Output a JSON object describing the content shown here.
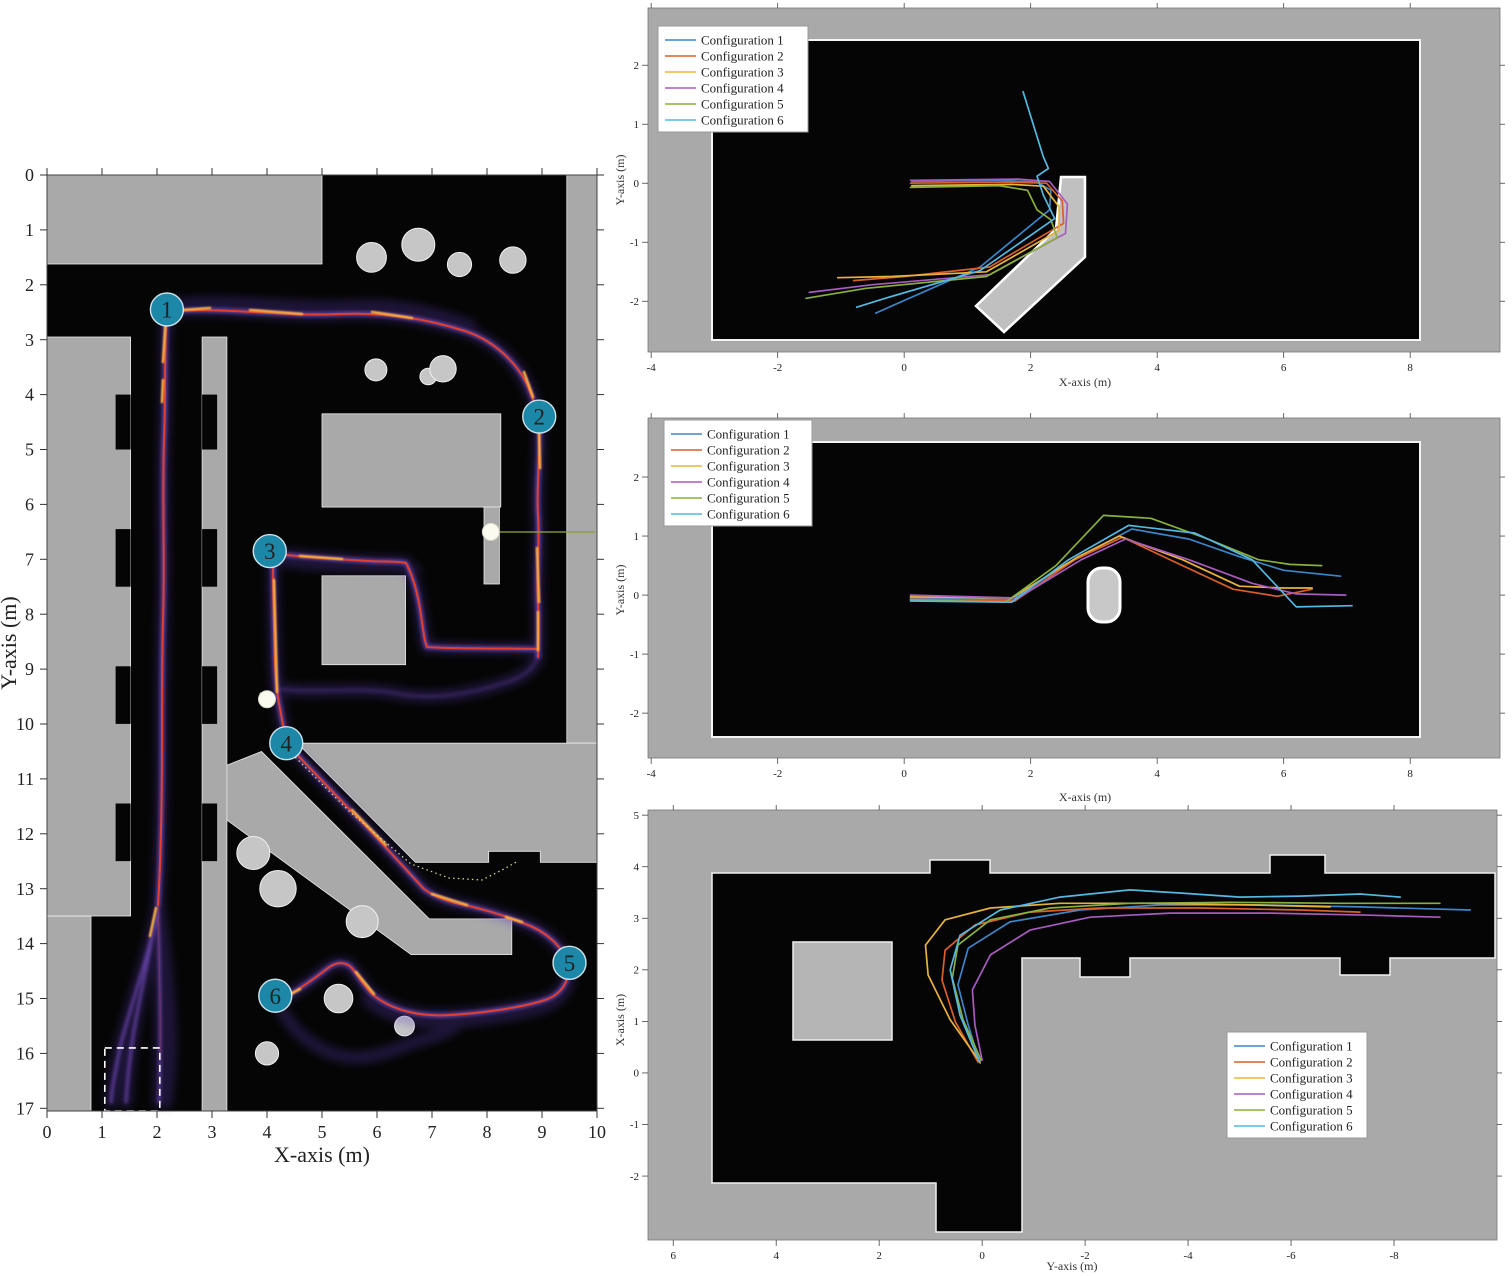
{
  "figure": {
    "background": "#ffffff",
    "wall_gray": "#a9a9a9",
    "obstacle_gray": "#c6c6c6",
    "free_space_black": "#050505",
    "waypoint_badge_color": "#1d87a8",
    "heat_core_color": "#e8402a",
    "heat_glow_color": "#5b3db8",
    "heat_hot_color": "#ffb43e"
  },
  "chart_data": {
    "type": "line",
    "description_units": "meters",
    "configs": [
      {
        "label": "Configuration 1",
        "color": "#3d85c8"
      },
      {
        "label": "Configuration 2",
        "color": "#d95f2b"
      },
      {
        "label": "Configuration 3",
        "color": "#e8b33c"
      },
      {
        "label": "Configuration 4",
        "color": "#a85bc0"
      },
      {
        "label": "Configuration 5",
        "color": "#8ab03c"
      },
      {
        "label": "Configuration 6",
        "color": "#55b8e0"
      }
    ],
    "left_heatmap": {
      "xlabel": "X-axis (m)",
      "ylabel": "Y-axis (m)",
      "xlim": [
        0,
        10
      ],
      "ylim": [
        0,
        17
      ],
      "x_ticks": [
        0,
        1,
        2,
        3,
        4,
        5,
        6,
        7,
        8,
        9,
        10
      ],
      "y_ticks": [
        0,
        1,
        2,
        3,
        4,
        5,
        6,
        7,
        8,
        9,
        10,
        11,
        12,
        13,
        14,
        15,
        16,
        17
      ],
      "waypoints": [
        {
          "id": "1",
          "x": 2.18,
          "y": 2.45
        },
        {
          "id": "2",
          "x": 8.95,
          "y": 4.4
        },
        {
          "id": "3",
          "x": 4.05,
          "y": 6.85
        },
        {
          "id": "4",
          "x": 4.35,
          "y": 10.35
        },
        {
          "id": "5",
          "x": 9.5,
          "y": 14.35
        },
        {
          "id": "6",
          "x": 4.15,
          "y": 14.95
        }
      ],
      "door_markers": [
        {
          "x": 8.07,
          "y": 6.5
        },
        {
          "x": 4.0,
          "y": 9.55
        }
      ],
      "start_zone": {
        "x0": 1.05,
        "y0": 15.9,
        "x1": 2.05,
        "y1": 17.0
      },
      "route_estimate": [
        [
          2.18,
          2.45
        ],
        [
          8.0,
          2.6
        ],
        [
          8.95,
          4.4
        ],
        [
          8.9,
          6.5
        ],
        [
          8.85,
          8.7
        ],
        [
          6.9,
          8.6
        ],
        [
          6.6,
          7.05
        ],
        [
          4.2,
          6.85
        ],
        [
          4.15,
          9.5
        ],
        [
          4.35,
          10.35
        ],
        [
          6.9,
          13.05
        ],
        [
          8.65,
          13.6
        ],
        [
          9.5,
          14.35
        ],
        [
          8.6,
          15.0
        ],
        [
          5.5,
          14.6
        ],
        [
          4.15,
          14.95
        ],
        [
          1.6,
          16.5
        ]
      ]
    },
    "panels": [
      {
        "id": "top",
        "xlabel": "X-axis (m)",
        "ylabel": "Y-axis (m)",
        "x_ticks": [
          -4,
          -2,
          0,
          2,
          4,
          6,
          8
        ],
        "y_ticks": [
          2,
          1,
          0,
          -1,
          -2
        ],
        "xlim": [
          -4.05,
          9.42
        ],
        "ylim": [
          -2.86,
          2.97
        ],
        "legend_position": "top-left",
        "series": [
          {
            "config": 0,
            "points": [
              [
                0.12,
                0.03
              ],
              [
                1.5,
                0.05
              ],
              [
                2.1,
                0.02
              ],
              [
                2.32,
                -0.12
              ],
              [
                2.3,
                -0.45
              ],
              [
                1.2,
                -1.42
              ],
              [
                -0.45,
                -2.2
              ]
            ]
          },
          {
            "config": 1,
            "points": [
              [
                0.1,
                0
              ],
              [
                1.6,
                0.02
              ],
              [
                2.25,
                0
              ],
              [
                2.5,
                -0.3
              ],
              [
                2.52,
                -0.68
              ],
              [
                1.35,
                -1.42
              ],
              [
                0,
                -1.58
              ],
              [
                -0.8,
                -1.65
              ]
            ]
          },
          {
            "config": 2,
            "points": [
              [
                0.12,
                -0.04
              ],
              [
                1.7,
                -0.02
              ],
              [
                2.2,
                -0.05
              ],
              [
                2.45,
                -0.4
              ],
              [
                2.45,
                -0.8
              ],
              [
                1.3,
                -1.5
              ],
              [
                -0.2,
                -1.58
              ],
              [
                -1.05,
                -1.6
              ]
            ]
          },
          {
            "config": 3,
            "points": [
              [
                0.1,
                0.05
              ],
              [
                1.8,
                0.07
              ],
              [
                2.3,
                0.03
              ],
              [
                2.58,
                -0.35
              ],
              [
                2.55,
                -0.85
              ],
              [
                1.35,
                -1.55
              ],
              [
                -0.5,
                -1.72
              ],
              [
                -1.5,
                -1.85
              ]
            ]
          },
          {
            "config": 4,
            "points": [
              [
                0.1,
                -0.07
              ],
              [
                1.5,
                -0.04
              ],
              [
                1.95,
                -0.12
              ],
              [
                2.1,
                -0.45
              ],
              [
                2.32,
                -0.62
              ],
              [
                2.42,
                -0.92
              ],
              [
                1.3,
                -1.58
              ],
              [
                -0.6,
                -1.78
              ],
              [
                -1.55,
                -1.95
              ]
            ]
          },
          {
            "config": 5,
            "points": [
              [
                1.88,
                1.55
              ],
              [
                2.2,
                0.45
              ],
              [
                2.28,
                0.25
              ],
              [
                2.1,
                0.12
              ],
              [
                2.2,
                -0.2
              ],
              [
                2.38,
                -0.6
              ],
              [
                1.2,
                -1.48
              ],
              [
                -0.3,
                -1.95
              ],
              [
                -0.75,
                -2.1
              ]
            ]
          }
        ]
      },
      {
        "id": "middle",
        "xlabel": "X-axis (m)",
        "ylabel": "Y-axis (m)",
        "x_ticks": [
          -4,
          -2,
          0,
          2,
          4,
          6,
          8
        ],
        "y_ticks": [
          2,
          1,
          0,
          -1,
          -2
        ],
        "xlim": [
          -4.05,
          9.42
        ],
        "ylim": [
          -2.76,
          3.0
        ],
        "legend_position": "top-left",
        "series": [
          {
            "config": 0,
            "points": [
              [
                0.1,
                -0.05
              ],
              [
                1.7,
                -0.08
              ],
              [
                2.6,
                0.55
              ],
              [
                3.6,
                1.12
              ],
              [
                4.5,
                0.95
              ],
              [
                5.3,
                0.65
              ],
              [
                6.0,
                0.42
              ],
              [
                6.9,
                0.32
              ]
            ]
          },
          {
            "config": 1,
            "points": [
              [
                0.1,
                -0.07
              ],
              [
                1.75,
                -0.1
              ],
              [
                2.7,
                0.6
              ],
              [
                3.45,
                0.98
              ],
              [
                4.3,
                0.55
              ],
              [
                5.2,
                0.1
              ],
              [
                5.9,
                -0.02
              ],
              [
                6.45,
                0.1
              ]
            ]
          },
          {
            "config": 2,
            "points": [
              [
                0.1,
                -0.03
              ],
              [
                1.7,
                -0.05
              ],
              [
                2.75,
                0.65
              ],
              [
                3.4,
                1.0
              ],
              [
                4.4,
                0.6
              ],
              [
                5.3,
                0.15
              ],
              [
                6.0,
                0.12
              ],
              [
                6.45,
                0.12
              ]
            ]
          },
          {
            "config": 3,
            "points": [
              [
                0.1,
                0.0
              ],
              [
                1.8,
                -0.05
              ],
              [
                2.8,
                0.6
              ],
              [
                3.5,
                0.95
              ],
              [
                4.5,
                0.6
              ],
              [
                5.5,
                0.2
              ],
              [
                6.2,
                0.02
              ],
              [
                6.98,
                0.0
              ]
            ]
          },
          {
            "config": 4,
            "points": [
              [
                0.1,
                -0.08
              ],
              [
                1.6,
                -0.12
              ],
              [
                2.4,
                0.5
              ],
              [
                3.15,
                1.35
              ],
              [
                3.9,
                1.3
              ],
              [
                4.8,
                0.95
              ],
              [
                5.6,
                0.6
              ],
              [
                6.1,
                0.52
              ],
              [
                6.6,
                0.5
              ]
            ]
          },
          {
            "config": 5,
            "points": [
              [
                0.1,
                -0.1
              ],
              [
                1.7,
                -0.12
              ],
              [
                2.6,
                0.6
              ],
              [
                3.55,
                1.18
              ],
              [
                4.6,
                1.05
              ],
              [
                5.5,
                0.6
              ],
              [
                6.2,
                -0.2
              ],
              [
                7.08,
                -0.18
              ]
            ]
          }
        ]
      },
      {
        "id": "bottom",
        "xlabel": "Y-axis (m)",
        "ylabel": "X-axis (m)",
        "x_ticks": [
          6,
          4,
          2,
          0,
          -2,
          -4,
          -6,
          -8
        ],
        "y_ticks": [
          5,
          4,
          3,
          2,
          1,
          0,
          -1,
          -2
        ],
        "xlim": [
          6.49,
          -10.0
        ],
        "ylim": [
          -3.24,
          5.1
        ],
        "legend_position": "bottom-right",
        "series": [
          {
            "config": 0,
            "points": [
              [
                0.04,
                0.19
              ],
              [
                0.27,
                0.93
              ],
              [
                0.47,
                1.71
              ],
              [
                0.27,
                2.42
              ],
              [
                -0.54,
                2.93
              ],
              [
                -1.9,
                3.16
              ],
              [
                -3.46,
                3.26
              ],
              [
                -5.4,
                3.26
              ],
              [
                -7.34,
                3.22
              ],
              [
                -9.48,
                3.16
              ]
            ]
          },
          {
            "config": 1,
            "points": [
              [
                0.08,
                0.21
              ],
              [
                0.52,
                0.99
              ],
              [
                0.78,
                1.8
              ],
              [
                0.72,
                2.38
              ],
              [
                0.14,
                2.87
              ],
              [
                -0.93,
                3.12
              ],
              [
                -2.29,
                3.2
              ],
              [
                -4.23,
                3.2
              ],
              [
                -6.17,
                3.16
              ],
              [
                -7.34,
                3.12
              ]
            ]
          },
          {
            "config": 2,
            "points": [
              [
                0.04,
                0.21
              ],
              [
                0.62,
                1.03
              ],
              [
                1.05,
                1.9
              ],
              [
                1.1,
                2.48
              ],
              [
                0.72,
                2.97
              ],
              [
                -0.16,
                3.2
              ],
              [
                -1.51,
                3.29
              ],
              [
                -3.26,
                3.29
              ],
              [
                -5.2,
                3.26
              ],
              [
                -6.76,
                3.22
              ]
            ]
          },
          {
            "config": 3,
            "points": [
              [
                0.0,
                0.25
              ],
              [
                0.14,
                0.93
              ],
              [
                0.19,
                1.61
              ],
              [
                -0.16,
                2.29
              ],
              [
                -0.93,
                2.77
              ],
              [
                -2.1,
                3.02
              ],
              [
                -3.65,
                3.1
              ],
              [
                -5.59,
                3.1
              ],
              [
                -7.53,
                3.06
              ],
              [
                -8.89,
                3.02
              ]
            ]
          },
          {
            "config": 4,
            "points": [
              [
                0.02,
                0.25
              ],
              [
                0.37,
                1.03
              ],
              [
                0.58,
                1.84
              ],
              [
                0.47,
                2.48
              ],
              [
                -0.16,
                2.97
              ],
              [
                -1.32,
                3.2
              ],
              [
                -2.87,
                3.29
              ],
              [
                -4.82,
                3.31
              ],
              [
                -6.95,
                3.29
              ],
              [
                -8.89,
                3.29
              ]
            ]
          },
          {
            "config": 5,
            "points": [
              [
                0.06,
                0.23
              ],
              [
                0.43,
                1.12
              ],
              [
                0.62,
                2.0
              ],
              [
                0.43,
                2.67
              ],
              [
                -0.35,
                3.16
              ],
              [
                -1.51,
                3.41
              ],
              [
                -2.87,
                3.55
              ],
              [
                -3.84,
                3.49
              ],
              [
                -5.01,
                3.41
              ],
              [
                -6.17,
                3.43
              ],
              [
                -7.34,
                3.47
              ],
              [
                -8.12,
                3.41
              ]
            ]
          }
        ]
      }
    ]
  }
}
